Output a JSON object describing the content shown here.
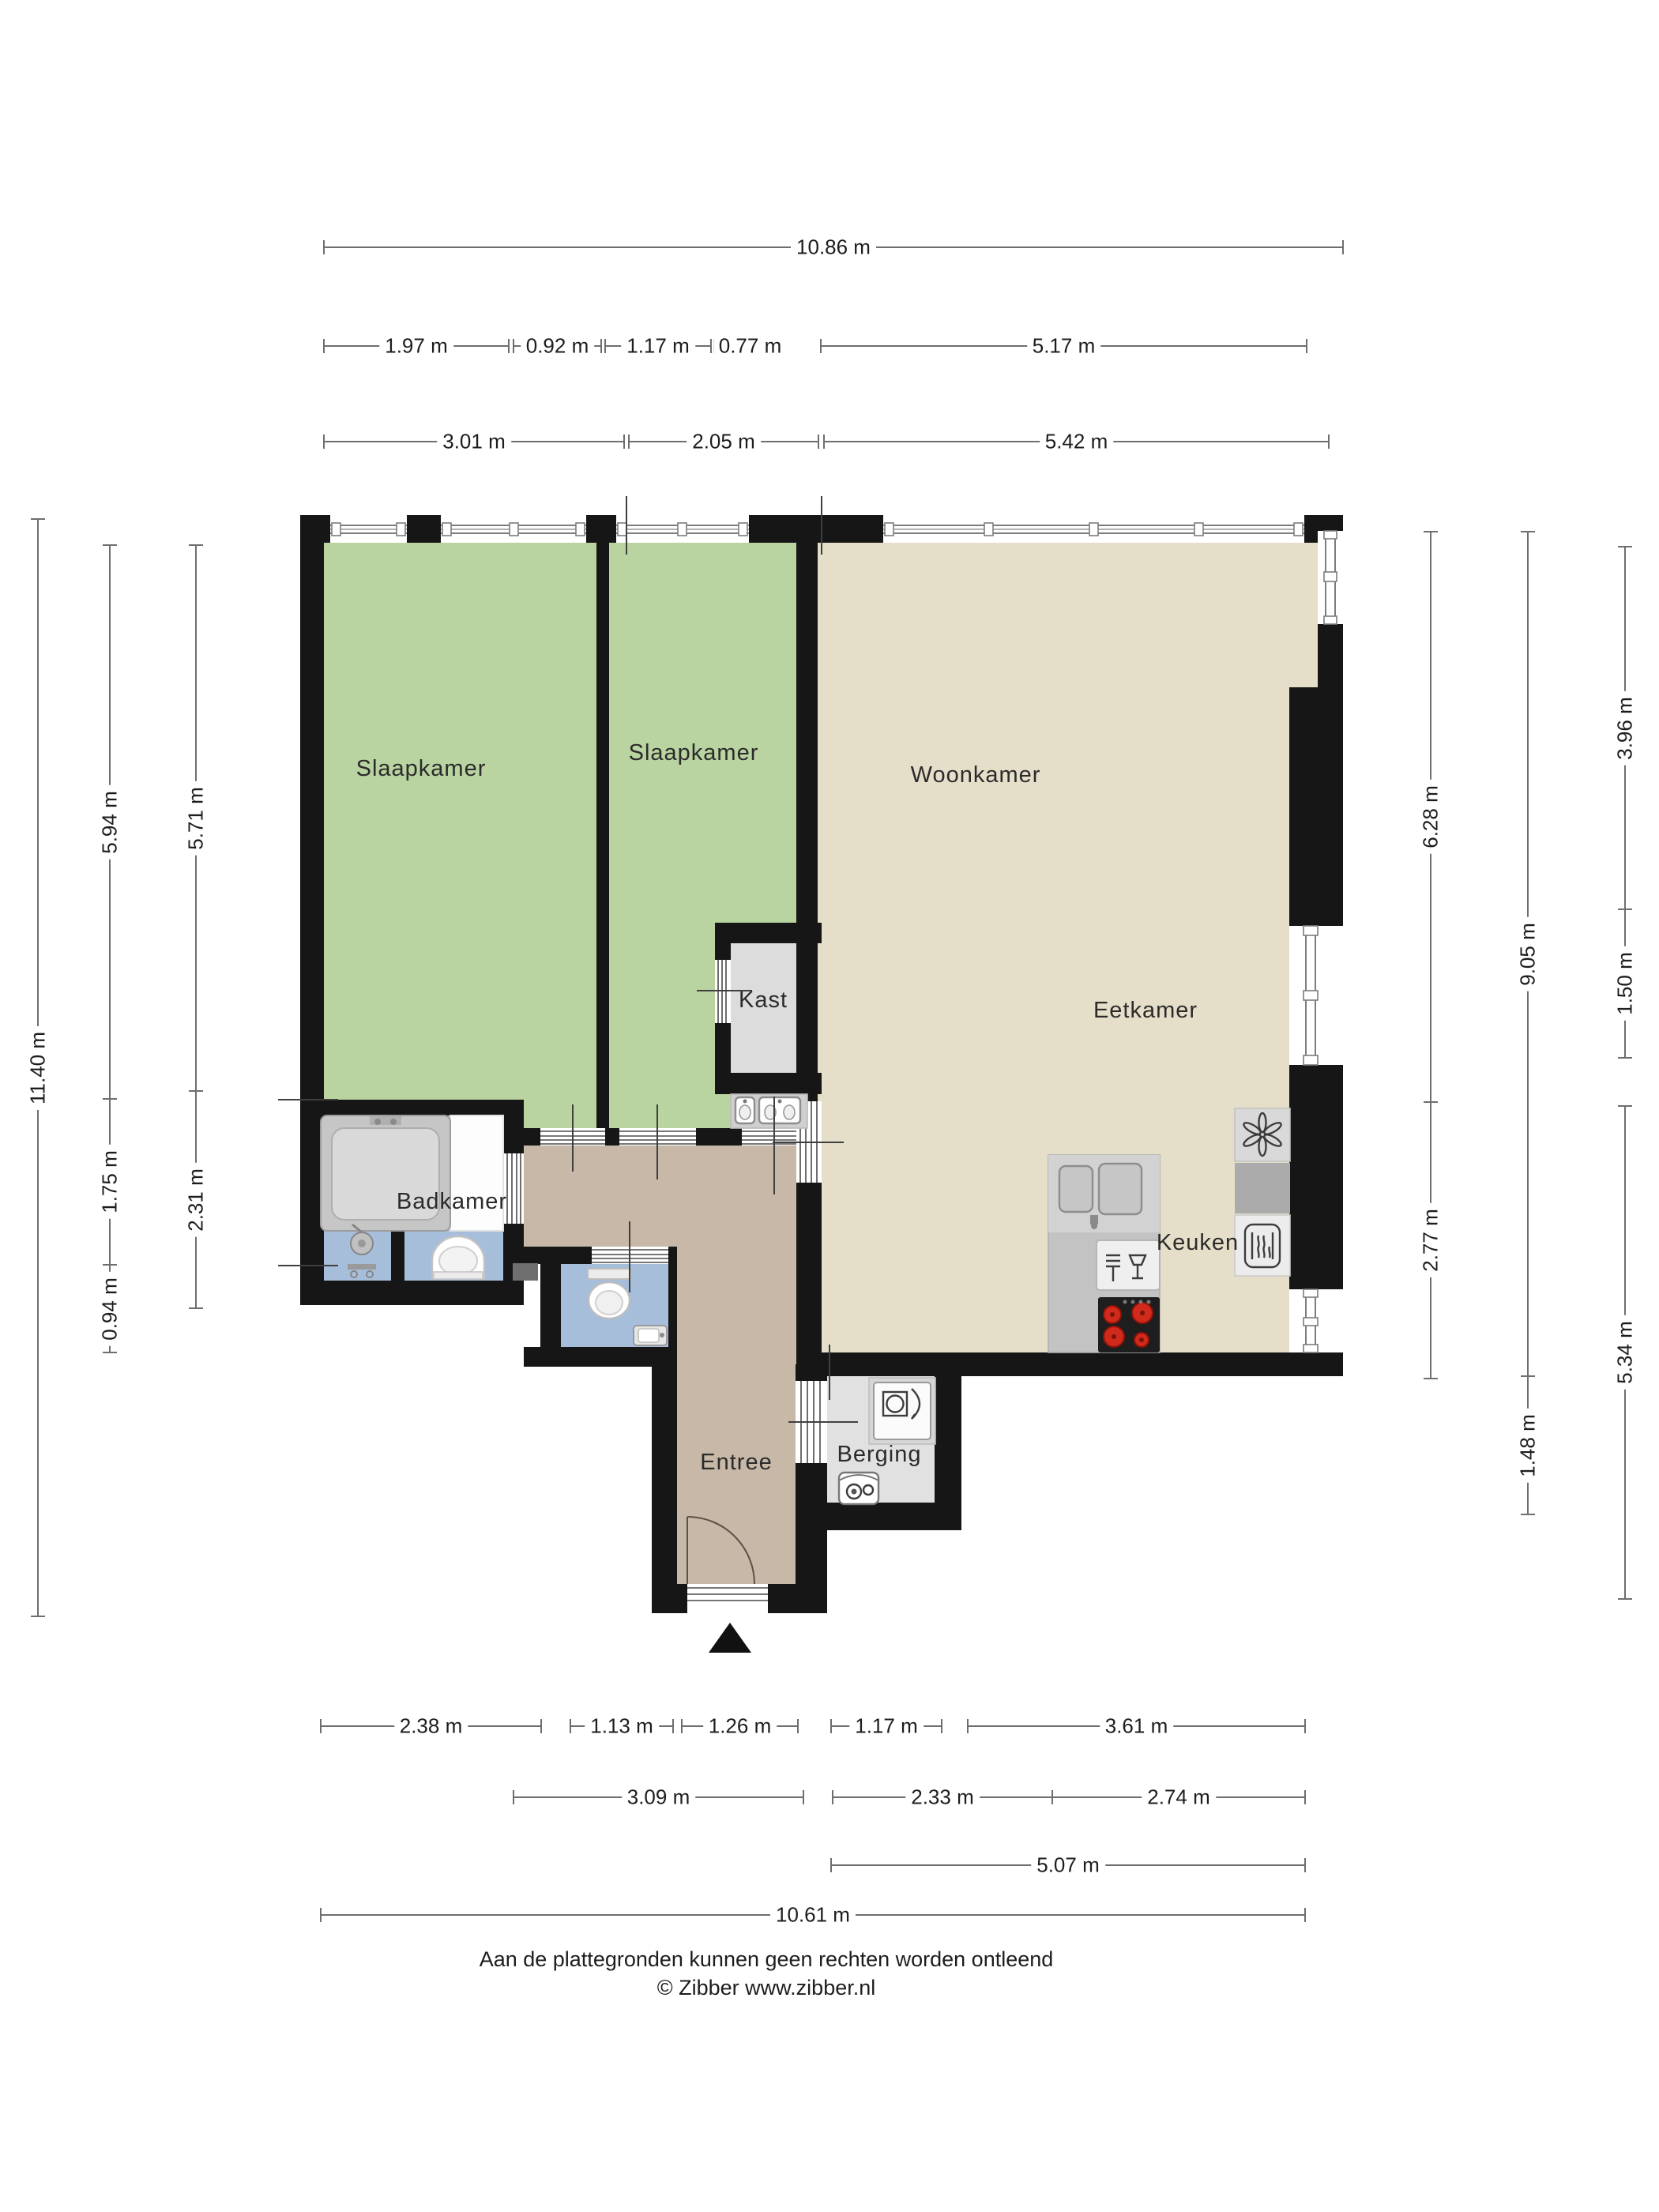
{
  "rooms": {
    "bedroom1": "Slaapkamer",
    "bedroom2": "Slaapkamer",
    "living": "Woonkamer",
    "dining": "Eetkamer",
    "closet": "Kast",
    "bathroom": "Badkamer",
    "kitchen": "Keuken",
    "entrance": "Entree",
    "storage": "Berging"
  },
  "dimensions": {
    "top": [
      [
        "10.86 m"
      ],
      [
        "1.97 m",
        "0.92 m",
        "1.17 m",
        "0.77 m",
        "5.17 m"
      ],
      [
        "3.01 m",
        "2.05 m",
        "5.42 m"
      ]
    ],
    "bottom": [
      [
        "2.38 m",
        "1.13 m",
        "1.26 m",
        "1.17 m",
        "3.61 m"
      ],
      [
        "3.09 m",
        "2.33 m",
        "2.74 m"
      ],
      [
        "5.07 m"
      ],
      [
        "10.61 m"
      ]
    ],
    "left": [
      [
        "11.40 m"
      ],
      [
        "5.94 m",
        "1.75 m",
        "0.94 m"
      ],
      [
        "5.71 m",
        "2.31 m"
      ]
    ],
    "right": [
      [
        "6.28 m",
        "2.77 m"
      ],
      [
        "9.05 m",
        "1.48 m"
      ],
      [
        "3.96 m",
        "1.50 m",
        "5.34 m"
      ]
    ]
  },
  "footer": [
    "Aan de plattegronden kunnen geen rechten worden ontleend",
    "© Zibber www.zibber.nl"
  ],
  "colors": {
    "wall": "#161616",
    "bedroom_floor": "#b9d3a1",
    "living_floor": "#e5dec9",
    "hall_floor": "#c7b8a7",
    "bath_floor": "#a7bedb",
    "closet_floor": "#dcdcdc",
    "storage_floor": "#e1e1e1",
    "counter": "#c9c9c9",
    "burner_red": "#cf2a1b",
    "dim_line": "#6e6e6e",
    "label_text": "#2b2b2b"
  }
}
